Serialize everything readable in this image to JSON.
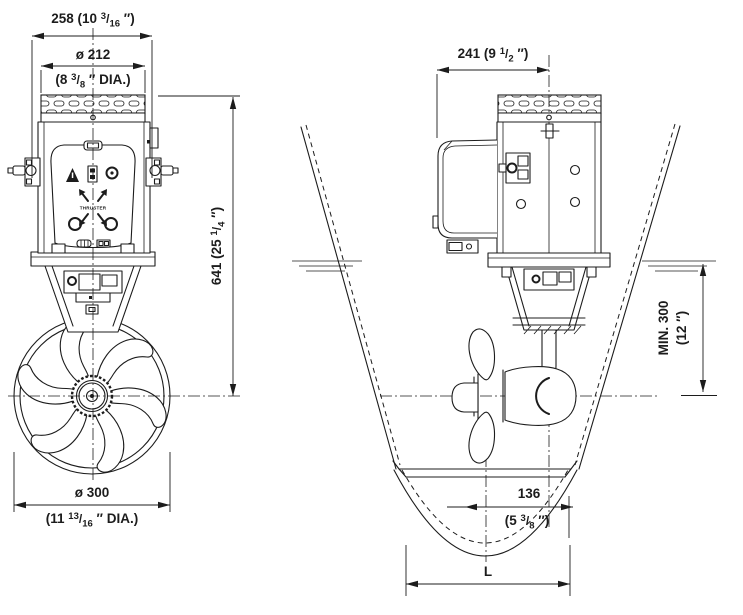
{
  "colors": {
    "line": "#1c1c1c",
    "background": "#ffffff"
  },
  "glyphs": {
    "fraction_slash": "/"
  },
  "front_view": {
    "name": "Bow thruster - front view",
    "logo_text": "THRUSTER",
    "dim_overall_width": {
      "pre": "258 (10 ",
      "num": "3",
      "den": "16",
      "post": " ″)"
    },
    "dim_motor_diameter": {
      "line1": "ø 212",
      "pre": "(8 ",
      "num": "3",
      "den": "8",
      "post": " ″ DIA.)"
    },
    "dim_overall_height": {
      "pre": "641 (25 ",
      "num": "1",
      "den": "4",
      "post": " ″)"
    },
    "dim_tunnel_diameter": {
      "line1": "ø 300",
      "pre": "(11 ",
      "num": "13",
      "den": "16",
      "post": " ″ DIA.)"
    }
  },
  "side_view": {
    "name": "Bow thruster - side installation view",
    "dim_top_width": {
      "pre": "241 (9 ",
      "num": "1",
      "den": "2",
      "post": " ″)"
    },
    "dim_min_submersion": {
      "line1": "MIN. 300",
      "line2": "(12 ″)"
    },
    "dim_center_offset": {
      "line1": "136",
      "pre": "(5 ",
      "num": "3",
      "den": "8",
      "post": " ″)"
    },
    "dim_tunnel_length": {
      "label": "L"
    }
  }
}
